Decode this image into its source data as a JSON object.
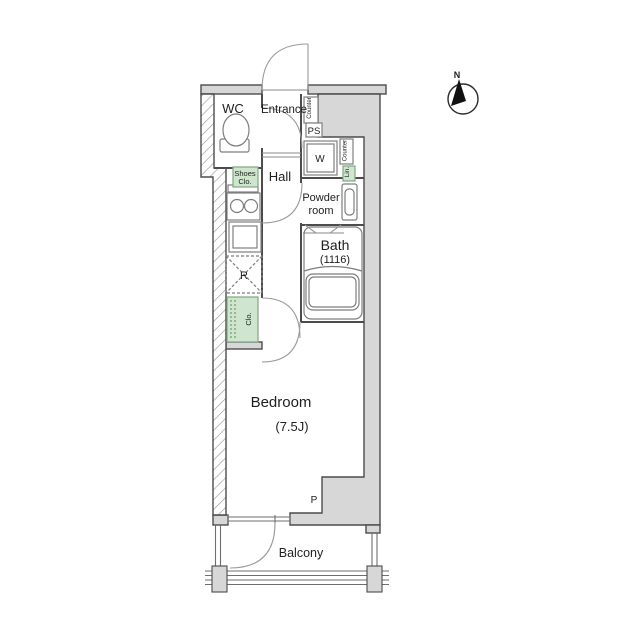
{
  "plan": {
    "rooms": {
      "wc": "WC",
      "entrance": "Entrance",
      "hall": "Hall",
      "powder_line1": "Powder",
      "powder_line2": "room",
      "bath": "Bath",
      "bath_size": "(1116)",
      "bedroom": "Bedroom",
      "bedroom_size": "(7.5J)",
      "balcony": "Balcony"
    },
    "fixtures": {
      "washing_machine": "W",
      "pipe_shaft": "PS",
      "pipe": "P",
      "refrigerator": "R",
      "counter_top": "Counter",
      "counter_mid": "Counter",
      "linen": "Lin.",
      "closet": "Clo.",
      "shoes_line1": "Shoes",
      "shoes_line2": "Clo."
    },
    "compass": {
      "north": "N"
    },
    "colors": {
      "wall_fill": "#d7d7d7",
      "storage_green": "#cfe5cd",
      "storage_green_border": "#7fa882",
      "outline": "#4c4c4c"
    }
  }
}
